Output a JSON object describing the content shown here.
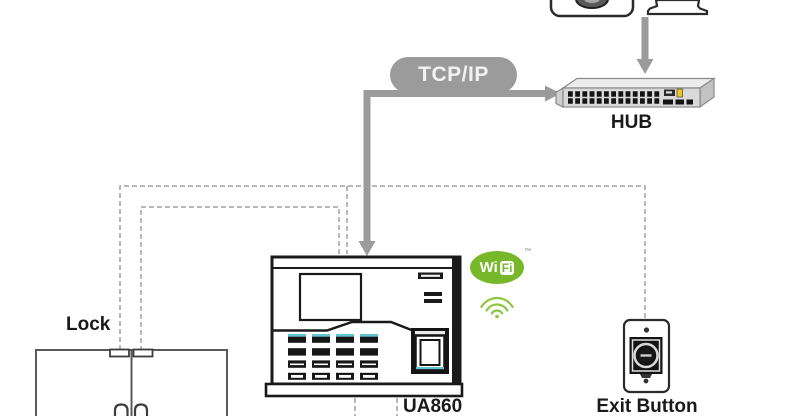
{
  "labels": {
    "tcpip": "TCP/IP",
    "hub": "HUB",
    "lock": "Lock",
    "device_model": "UA860",
    "exit_button": "Exit Button"
  },
  "wifi_logo": {
    "wi": "Wi",
    "fi": "Fi",
    "trademark": "™"
  },
  "colors": {
    "connector": "#9b9b9b",
    "dashed_line": "#a0a0a0",
    "outline_dark": "#1a1a1a",
    "door_outline": "#5a5a5a",
    "keypad_accent": "#63c3d1",
    "wifi_green": "#76b82a",
    "wifi_arc_green": "#8dc63f",
    "hub_port_dark": "#141414",
    "hub_accent_yellow": "#f0c419",
    "tcpip_text": "#f2f2f2"
  }
}
